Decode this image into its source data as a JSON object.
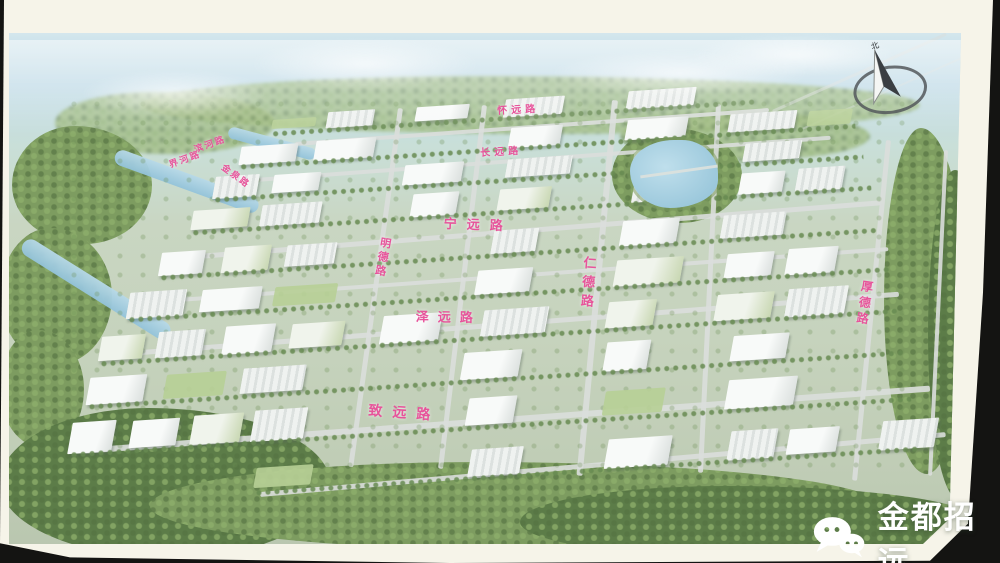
{
  "map": {
    "label_color": "#e7549b",
    "road_labels": [
      {
        "name": "huaiyuan",
        "text": "怀远路",
        "x": 497,
        "y": 107,
        "rot": -3,
        "size": 10,
        "spacing": 4,
        "orient": "h"
      },
      {
        "name": "changyuan",
        "text": "长远路",
        "x": 480,
        "y": 149,
        "rot": -3,
        "size": 10,
        "spacing": 4,
        "orient": "h"
      },
      {
        "name": "ningyuan",
        "text": "宁远路",
        "x": 444,
        "y": 217,
        "rot": 2,
        "size": 13,
        "spacing": 10,
        "orient": "h"
      },
      {
        "name": "zeyuan",
        "text": "泽远路",
        "x": 416,
        "y": 310,
        "rot": 1,
        "size": 13,
        "spacing": 9,
        "orient": "h"
      },
      {
        "name": "zhiyuan",
        "text": "致远路",
        "x": 369,
        "y": 403,
        "rot": 4,
        "size": 14,
        "spacing": 10,
        "orient": "h"
      },
      {
        "name": "rende",
        "text": "仁德路",
        "x": 584,
        "y": 256,
        "rot": 4,
        "size": 13,
        "spacing": 6,
        "orient": "v"
      },
      {
        "name": "mingde",
        "text": "明德路",
        "x": 381,
        "y": 238,
        "rot": 10,
        "size": 11,
        "spacing": 3,
        "orient": "v"
      },
      {
        "name": "houde",
        "text": "厚德路",
        "x": 862,
        "y": 280,
        "rot": 8,
        "size": 12,
        "spacing": 4,
        "orient": "v"
      },
      {
        "name": "binhe",
        "text": "滨河路",
        "x": 193,
        "y": 146,
        "rot": -20,
        "size": 9,
        "spacing": 2,
        "orient": "h"
      },
      {
        "name": "jiehe",
        "text": "界河路",
        "x": 168,
        "y": 161,
        "rot": -20,
        "size": 9,
        "spacing": 2,
        "orient": "h"
      },
      {
        "name": "jinquan",
        "text": "金泉路",
        "x": 225,
        "y": 163,
        "rot": 36,
        "size": 9,
        "spacing": 2,
        "orient": "h"
      }
    ],
    "compass": {
      "north_label": "北"
    }
  },
  "watermark": {
    "text": "金都招远"
  },
  "colors": {
    "label_pink": "#e7549b",
    "board_frame": "#f6f4e9",
    "sky_blue": "#c2dce8",
    "forest_green": "#5c7c48",
    "building_white": "#f8faf9",
    "water_blue": "#9cc8dc"
  }
}
